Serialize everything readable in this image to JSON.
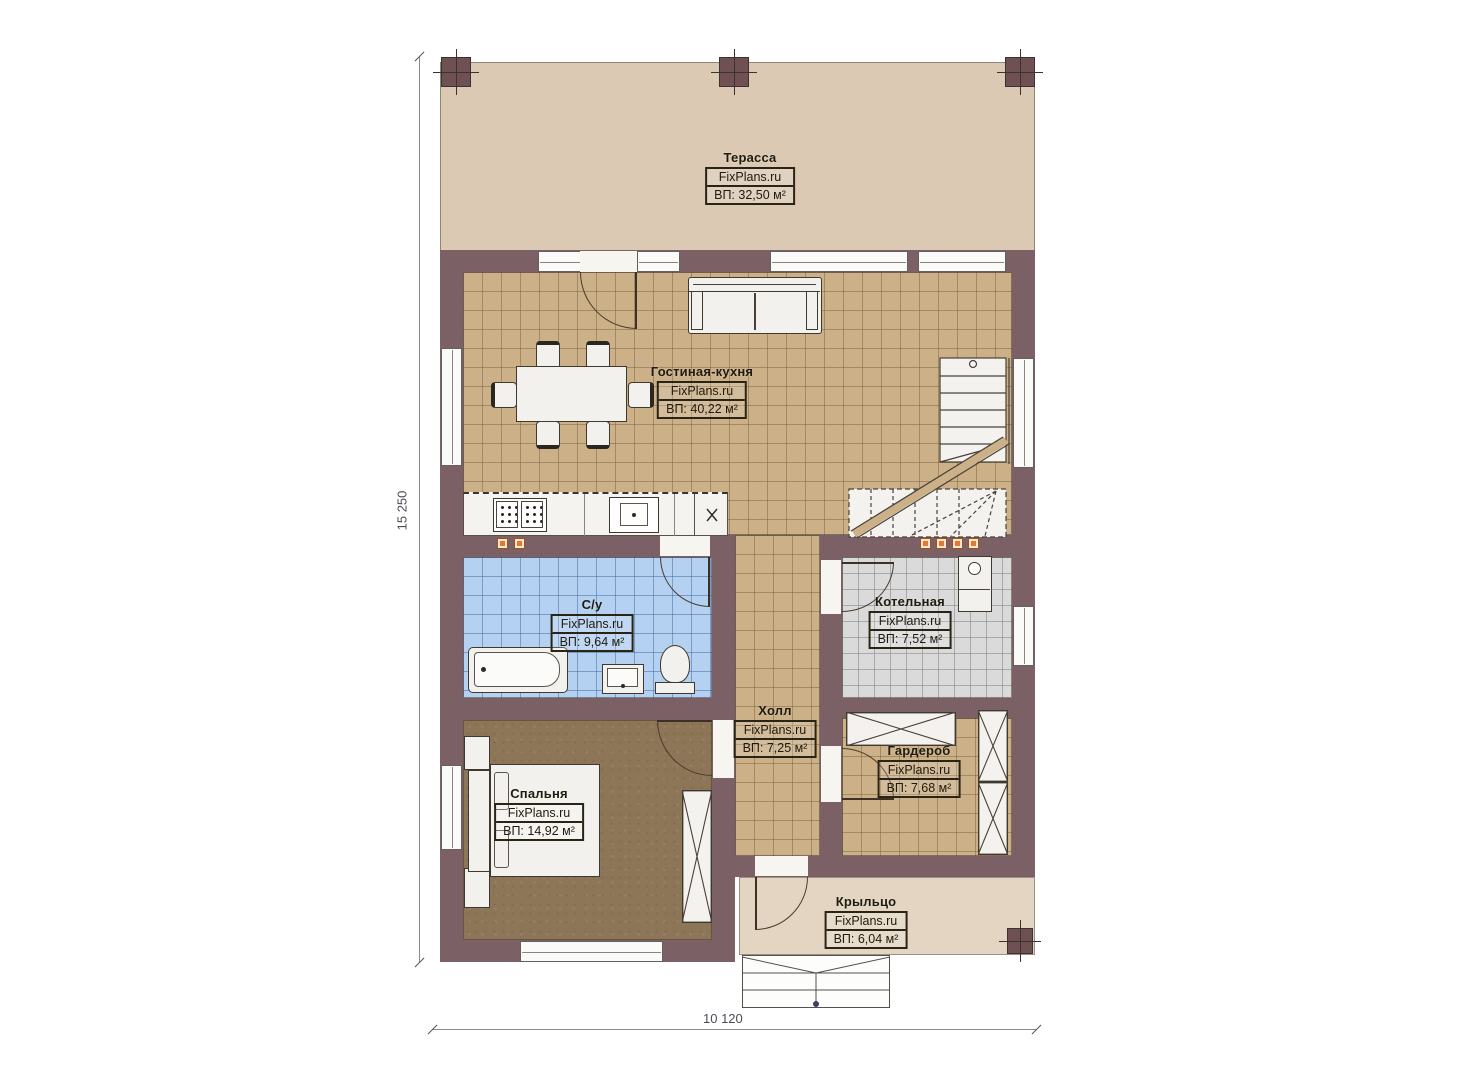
{
  "plan_title": "Floor plan (first floor)",
  "brand": "FixPlans.ru",
  "rooms": [
    {
      "id": "terrace",
      "name": "Терасса",
      "brand": "FixPlans.ru",
      "area": "ВП: 32,50 м²"
    },
    {
      "id": "living-kitchen",
      "name": "Гостиная-кухня",
      "brand": "FixPlans.ru",
      "area": "ВП: 40,22 м²"
    },
    {
      "id": "bathroom",
      "name": "С/у",
      "brand": "FixPlans.ru",
      "area": "ВП: 9,64 м²"
    },
    {
      "id": "boiler-room",
      "name": "Котельная",
      "brand": "FixPlans.ru",
      "area": "ВП: 7,52 м²"
    },
    {
      "id": "hall",
      "name": "Холл",
      "brand": "FixPlans.ru",
      "area": "ВП: 7,25 м²"
    },
    {
      "id": "wardrobe",
      "name": "Гардероб",
      "brand": "FixPlans.ru",
      "area": "ВП: 7,68 м²"
    },
    {
      "id": "bedroom",
      "name": "Спальня",
      "brand": "FixPlans.ru",
      "area": "ВП: 14,92 м²"
    },
    {
      "id": "porch",
      "name": "Крыльцо",
      "brand": "FixPlans.ru",
      "area": "ВП: 6,04 м²"
    }
  ],
  "dimensions": {
    "left_total": "15 250",
    "bottom_total": "10 120"
  },
  "colors": {
    "wall": "#7b6165",
    "terrace_floor": "#dbc9b4",
    "porch_floor": "#e3d5c1",
    "living_tile": "#cbb088",
    "bathroom_tile": "#b4d1f1",
    "boiler_tile": "#dadada",
    "bedroom_floor": "#8d7557",
    "vent_accent": "#e8772b"
  }
}
